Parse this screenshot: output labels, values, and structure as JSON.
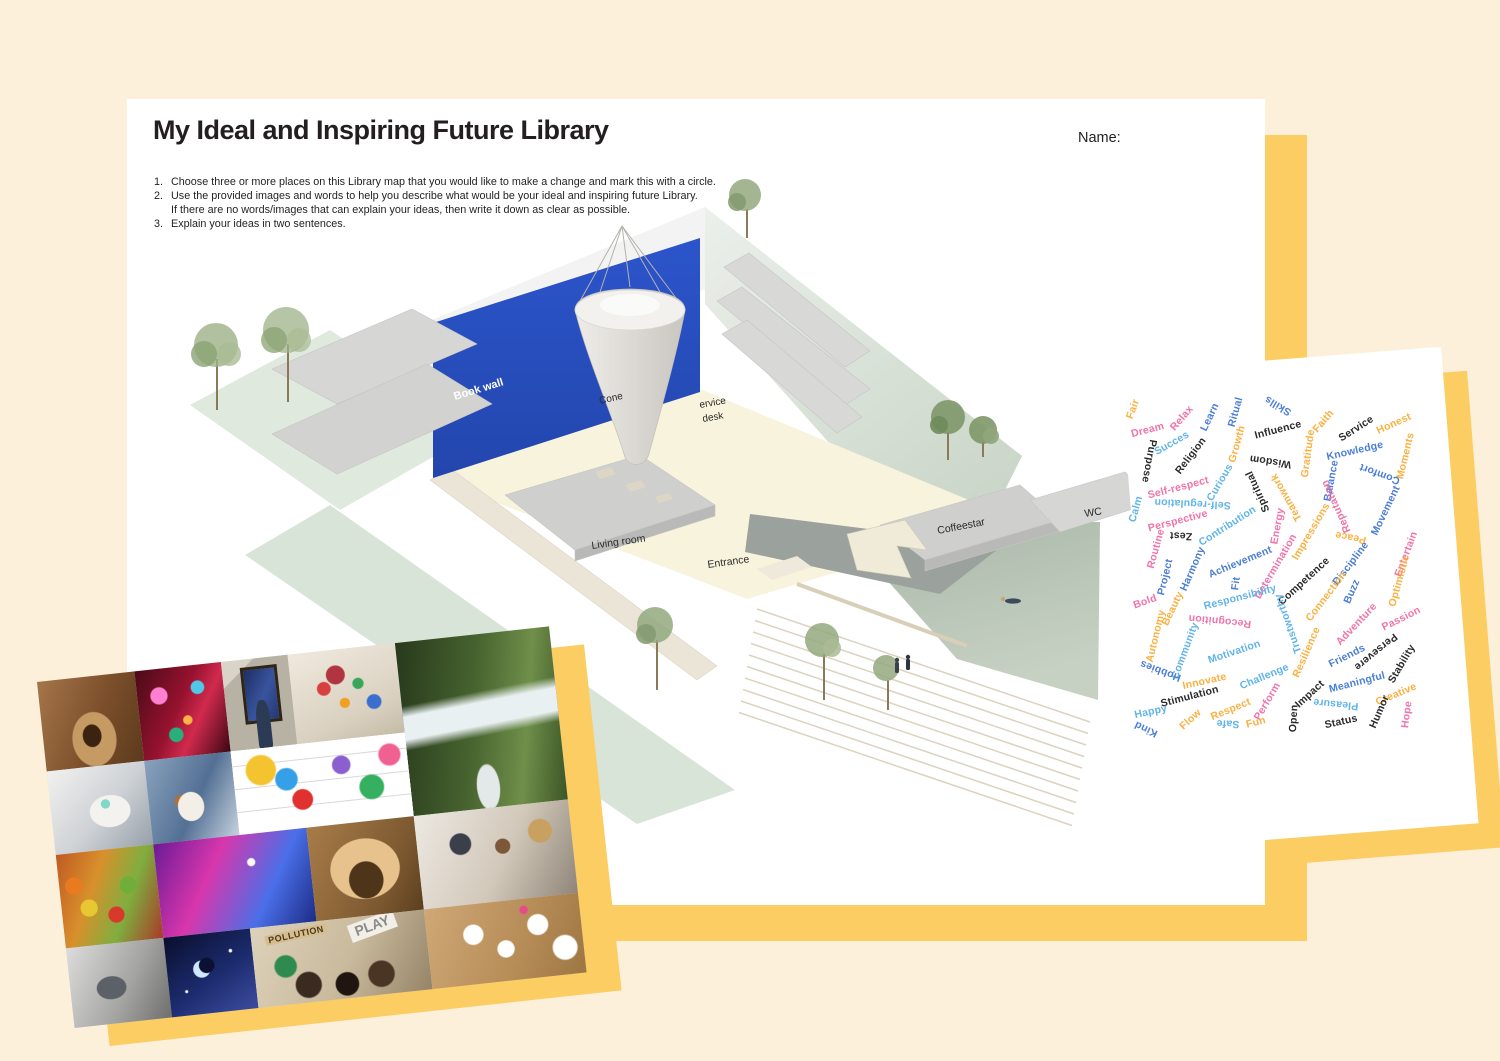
{
  "page": {
    "title": "My Ideal and Inspiring Future Library",
    "name_label": "Name:",
    "instructions": [
      {
        "num": "1.",
        "lines": [
          "Choose three or more places on this Library map that you would like to make a change and mark this with a circle."
        ]
      },
      {
        "num": "2.",
        "lines": [
          "Use the provided images and words to help you describe what would be your ideal and inspiring future Library.",
          "If there are no words/images that can explain your ideas, then write it down as clear as possible."
        ]
      },
      {
        "num": "3.",
        "lines": [
          "Explain your ideas in two sentences."
        ]
      }
    ]
  },
  "map": {
    "labels": [
      {
        "t": "Book wall",
        "x": 298,
        "y": 246,
        "r": -17,
        "c": "#ffffff",
        "s": 11,
        "b": true
      },
      {
        "t": "Cone",
        "x": 443,
        "y": 250,
        "r": -13,
        "c": "#2b2b2b",
        "s": 10,
        "b": false
      },
      {
        "t": "ervice",
        "x": 543,
        "y": 254,
        "r": -10,
        "c": "#2b2b2b",
        "s": 10,
        "b": false
      },
      {
        "t": "desk",
        "x": 546,
        "y": 268,
        "r": -10,
        "c": "#2b2b2b",
        "s": 10,
        "b": false
      },
      {
        "t": "Coffeestar",
        "x": 781,
        "y": 380,
        "r": -11,
        "c": "#2b2b2b",
        "s": 10.5,
        "b": false
      },
      {
        "t": "WC",
        "x": 928,
        "y": 363,
        "r": -9,
        "c": "#2b2b2b",
        "s": 10.5,
        "b": false
      },
      {
        "t": "Living room",
        "x": 435,
        "y": 395,
        "r": -8,
        "c": "#2b2b2b",
        "s": 10.5,
        "b": false
      },
      {
        "t": "Entrance",
        "x": 551,
        "y": 414,
        "r": -8,
        "c": "#2b2b2b",
        "s": 10.5,
        "b": false
      }
    ]
  },
  "word_card": {
    "palette": {
      "p": "#F272A9",
      "lb": "#5FB4E8",
      "b": "#4B7ED6",
      "y": "#FBB040",
      "k": "#2B2B2B"
    },
    "words": [
      [
        "Fair",
        13,
        37,
        -65,
        "y"
      ],
      [
        "Dream",
        28,
        58,
        -10,
        "p"
      ],
      [
        "Relax",
        62,
        46,
        -45,
        "p"
      ],
      [
        "Learn",
        90,
        45,
        -60,
        "b"
      ],
      [
        "Ritual",
        115,
        40,
        -70,
        "b"
      ],
      [
        "Skills",
        158,
        34,
        215,
        "b"
      ],
      [
        "Influence",
        158,
        58,
        -10,
        "k"
      ],
      [
        "Faith",
        203,
        49,
        -45,
        "y"
      ],
      [
        "Service",
        236,
        57,
        -28,
        "k"
      ],
      [
        "Honest",
        274,
        52,
        -20,
        "y"
      ],
      [
        "Succes",
        52,
        71,
        -25,
        "lb"
      ],
      [
        "Purpose",
        29,
        89,
        105,
        "k"
      ],
      [
        "Religion",
        71,
        84,
        -48,
        "k"
      ],
      [
        "Growth",
        117,
        72,
        -70,
        "y"
      ],
      [
        "Wisdom",
        150,
        90,
        193,
        "k"
      ],
      [
        "Gratitude",
        188,
        82,
        -78,
        "y"
      ],
      [
        "Knowledge",
        235,
        79,
        -8,
        "b"
      ],
      [
        "Moments",
        285,
        84,
        -72,
        "y"
      ],
      [
        "Comfort",
        260,
        102,
        205,
        "b"
      ],
      [
        "Balance",
        211,
        109,
        -75,
        "b"
      ],
      [
        "Self-respect",
        58,
        116,
        -10,
        "p"
      ],
      [
        "Curious",
        100,
        111,
        -55,
        "lb"
      ],
      [
        "Spiritual",
        138,
        120,
        250,
        "k"
      ],
      [
        "Teamwork",
        166,
        125,
        245,
        "y"
      ],
      [
        "Reputation",
        216,
        135,
        250,
        "p"
      ],
      [
        "Movement",
        266,
        139,
        -60,
        "b"
      ],
      [
        "Self-regulation",
        73,
        132,
        187,
        "lb"
      ],
      [
        "Calm",
        16,
        137,
        -70,
        "lb"
      ],
      [
        "Perspective",
        58,
        149,
        -10,
        "p"
      ],
      [
        "Zest",
        61,
        164,
        187,
        "k"
      ],
      [
        "Contribution",
        107,
        154,
        -28,
        "lb"
      ],
      [
        "Energy",
        157,
        154,
        -75,
        "p"
      ],
      [
        "Impressions",
        191,
        160,
        -55,
        "y"
      ],
      [
        "Peace",
        231,
        165,
        195,
        "y"
      ],
      [
        "Entertain",
        286,
        182,
        -65,
        "p"
      ],
      [
        "Routine",
        36,
        177,
        -70,
        "p"
      ],
      [
        "Harmony",
        73,
        197,
        -62,
        "b"
      ],
      [
        "Achievement",
        120,
        190,
        -18,
        "b"
      ],
      [
        "Determination",
        156,
        194,
        -55,
        "p"
      ],
      [
        "Competence",
        184,
        209,
        -38,
        "k"
      ],
      [
        "Discipline",
        231,
        192,
        -48,
        "b"
      ],
      [
        "Optimistic",
        279,
        209,
        -70,
        "y"
      ],
      [
        "Project",
        45,
        205,
        -72,
        "b"
      ],
      [
        "Fit",
        116,
        212,
        -78,
        "b"
      ],
      [
        "Responsibility",
        120,
        225,
        -10,
        "lb"
      ],
      [
        "Connection",
        206,
        225,
        -48,
        "y"
      ],
      [
        "Buzz",
        232,
        220,
        -62,
        "b"
      ],
      [
        "Bold",
        25,
        230,
        -15,
        "p"
      ],
      [
        "Beauty",
        53,
        237,
        -60,
        "y"
      ],
      [
        "Recognition",
        100,
        249,
        190,
        "p"
      ],
      [
        "Trustworthy",
        168,
        252,
        255,
        "lb"
      ],
      [
        "Adventure",
        236,
        252,
        -42,
        "p"
      ],
      [
        "Passion",
        281,
        247,
        -22,
        "p"
      ],
      [
        "Autonomy",
        36,
        264,
        -72,
        "y"
      ],
      [
        "Community",
        65,
        279,
        -65,
        "lb"
      ],
      [
        "Motivation",
        114,
        280,
        -14,
        "lb"
      ],
      [
        "Resilience",
        186,
        280,
        -62,
        "y"
      ],
      [
        "Friends",
        227,
        284,
        -22,
        "b"
      ],
      [
        "Persevere",
        256,
        280,
        145,
        "k"
      ],
      [
        "Stability",
        282,
        292,
        -55,
        "k"
      ],
      [
        "Hobbies",
        40,
        299,
        205,
        "b"
      ],
      [
        "Innovate",
        84,
        309,
        -8,
        "y"
      ],
      [
        "Challenge",
        144,
        305,
        -18,
        "lb"
      ],
      [
        "Meaningful",
        237,
        310,
        -10,
        "b"
      ],
      [
        "Impact",
        190,
        322,
        -38,
        "k"
      ],
      [
        "Stimulation",
        70,
        325,
        -10,
        "k"
      ],
      [
        "Creative",
        276,
        322,
        -18,
        "y"
      ],
      [
        "Pleasure",
        216,
        332,
        190,
        "lb"
      ],
      [
        "Happy",
        31,
        340,
        -8,
        "lb"
      ],
      [
        "Flow",
        70,
        348,
        -38,
        "y"
      ],
      [
        "Respect",
        111,
        337,
        -18,
        "y"
      ],
      [
        "Perform",
        147,
        330,
        -55,
        "p"
      ],
      [
        "Safe",
        108,
        352,
        187,
        "lb"
      ],
      [
        "Fun",
        136,
        350,
        -10,
        "y"
      ],
      [
        "Open",
        174,
        346,
        -82,
        "k"
      ],
      [
        "Status",
        221,
        350,
        -8,
        "k"
      ],
      [
        "Humor",
        259,
        340,
        -62,
        "k"
      ],
      [
        "Hope",
        287,
        343,
        -78,
        "p"
      ],
      [
        "Kind",
        26,
        357,
        210,
        "b"
      ]
    ]
  },
  "collage": {
    "tiles": [
      {
        "id": "pottery",
        "name": "pottery-wheel-photo"
      },
      {
        "id": "party",
        "name": "party-lights-photo"
      },
      {
        "id": "starry",
        "name": "museum-painting-photo"
      },
      {
        "id": "dominoes",
        "name": "dominoes-playroom-photo"
      },
      {
        "id": "waterfall",
        "name": "waterfall-hiker-photo"
      },
      {
        "id": "couch",
        "name": "relaxing-headphones-photo"
      },
      {
        "id": "dog",
        "name": "petting-dog-photo"
      },
      {
        "id": "memes",
        "name": "meme-doodles-photo"
      },
      {
        "id": "market",
        "name": "street-market-photo"
      },
      {
        "id": "digital",
        "name": "digital-art-room-photo"
      },
      {
        "id": "meditate",
        "name": "meditation-photo"
      },
      {
        "id": "team",
        "name": "group-collaboration-photo"
      },
      {
        "id": "reading",
        "name": "man-reading-photo"
      },
      {
        "id": "sky",
        "name": "night-sky-moon-photo"
      },
      {
        "id": "protest",
        "name": "protest-signs-photo"
      },
      {
        "id": "puzzle",
        "name": "puzzle-pieces-photo"
      }
    ],
    "signs": [
      "POLLUTION",
      "PLAY"
    ]
  }
}
